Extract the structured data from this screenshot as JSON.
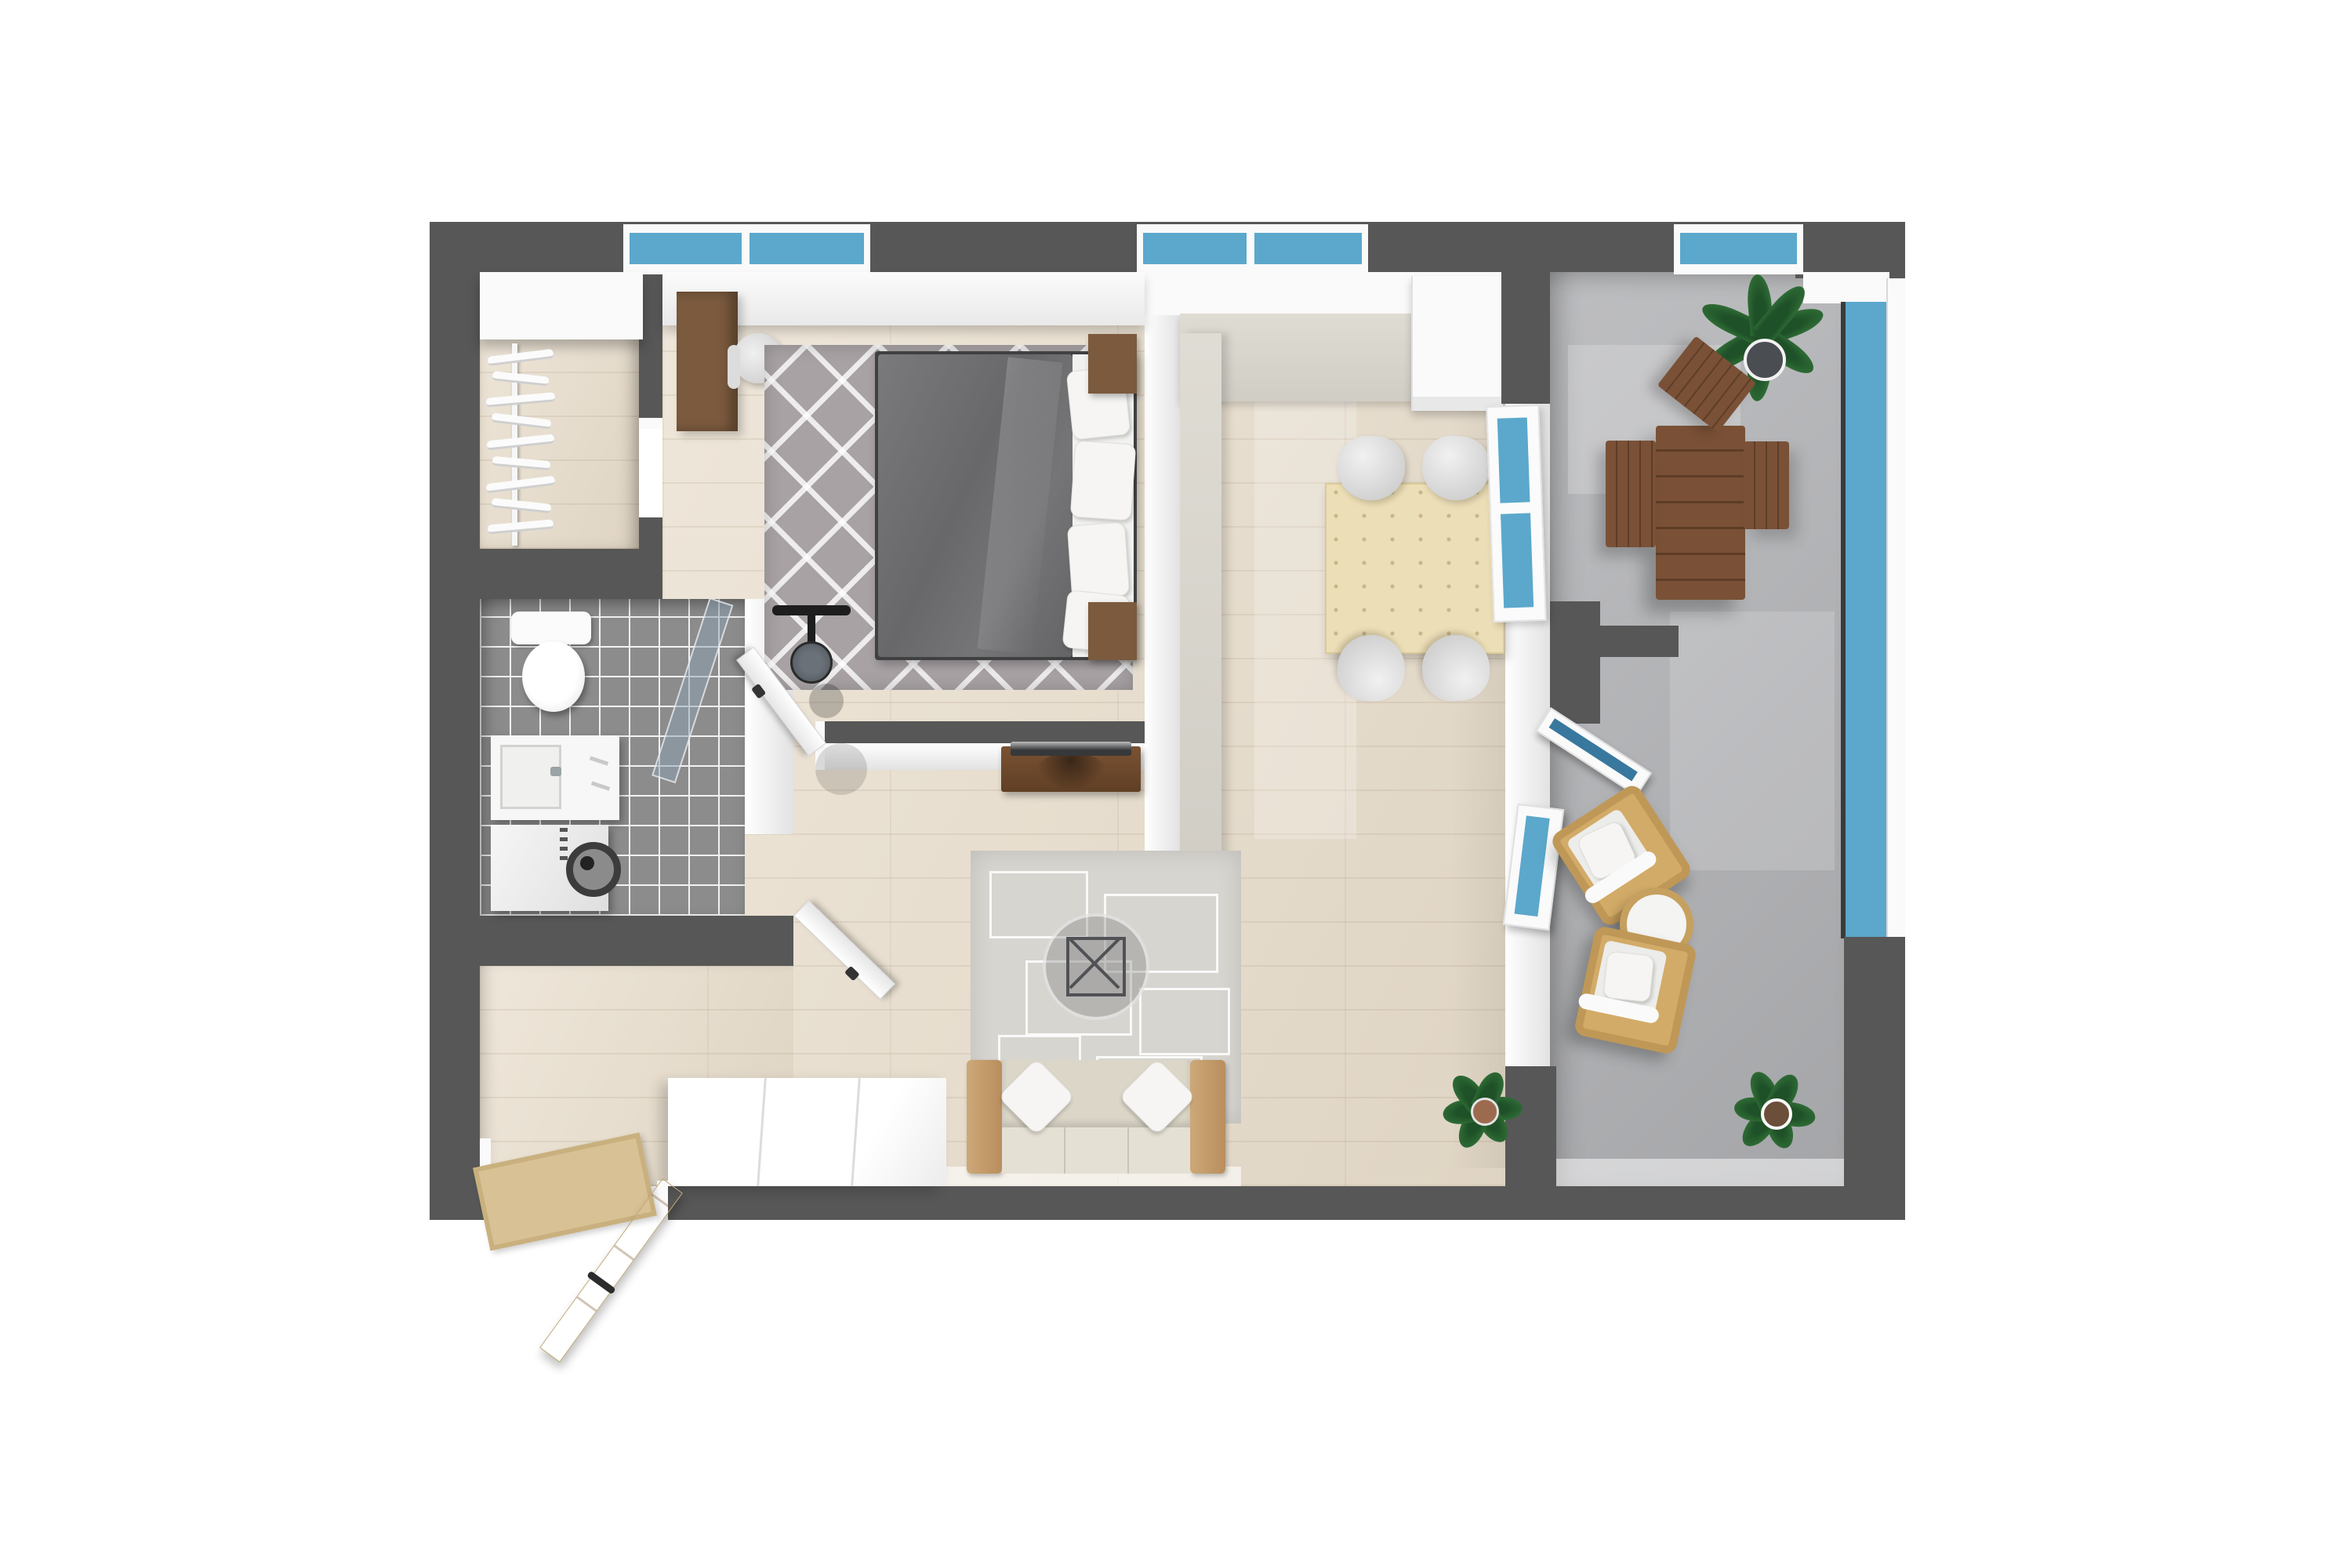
{
  "scene": {
    "title": "3D apartment floor plan, top-down view",
    "type": "floor-plan-render",
    "colors": {
      "wall": "#575757",
      "frame_white": "#fafafa",
      "inner_wall": "#f1f1f1",
      "wood_floor": "#e8ddcb",
      "tile_floor": "#8c8c8c",
      "balcony_floor": "#b1b2b5",
      "glass_blue": "#5ba8cc",
      "glass_deep": "#39789e",
      "duvet": "#6e6e70",
      "bed_frame": "#3f4042",
      "sheet": "#f1f1ef",
      "rug_bedroom": "#a8a2a4",
      "rug_living": "#d7d5d0",
      "sofa_beige": "#dcd6c8",
      "seat_beige": "#e5e0d4",
      "sofa_arm": "#c49a6b",
      "pillow_white": "#f6f5f3",
      "pine": "#ecdeb6",
      "counter_stone": "#dfdcd4",
      "sink_dark": "#31393b",
      "sink_rim": "#a9adad",
      "stove_black": "#181818",
      "burner_red": "#bf1220",
      "tv_brown": "#6b4628",
      "tv_screen": "#36383a",
      "desk_wood": "#7b5a3e",
      "out_wood": "#7a5136",
      "out_wood_dark": "#5e3d27",
      "wicker": "#bf9857",
      "wicker_light": "#d3ab68",
      "plant_green": "#2e6b35",
      "plant_dark": "#1f5128",
      "door_wood": "#d9c39c",
      "metal_gray": "#596066"
    },
    "rooms": [
      {
        "name": "walk-in-closet",
        "furniture": [
          "wardrobe",
          "spiral-clothes-rack"
        ]
      },
      {
        "name": "bedroom",
        "furniture": [
          "window",
          "desk",
          "office-chair",
          "zigzag-rug",
          "double-bed",
          "pillows",
          "nightstand-top",
          "nightstand-bottom",
          "door"
        ]
      },
      {
        "name": "bathroom",
        "furniture": [
          "toilet",
          "shower-fixture",
          "shower-glass-panel",
          "sink-vanity",
          "washing-machine",
          "door"
        ]
      },
      {
        "name": "entry-hall",
        "furniture": [
          "front-door",
          "doormat"
        ]
      },
      {
        "name": "kitchen",
        "furniture": [
          "window",
          "counter",
          "sink",
          "cooktop",
          "tall-cabinet"
        ]
      },
      {
        "name": "living-dining-room",
        "furniture": [
          "tv-stand",
          "tv",
          "area-rug",
          "coffee-table",
          "sofa",
          "throw-pillows",
          "sideboard",
          "dining-table",
          "dining-chairs",
          "potted-plant",
          "balcony-door"
        ]
      },
      {
        "name": "balcony",
        "furniture": [
          "outdoor-dining-table",
          "folding-chairs",
          "palm-plant",
          "wicker-armchair",
          "wicker-armchair",
          "round-side-table",
          "potted-plant",
          "glass-railing",
          "tilt-open-windows"
        ]
      }
    ]
  }
}
